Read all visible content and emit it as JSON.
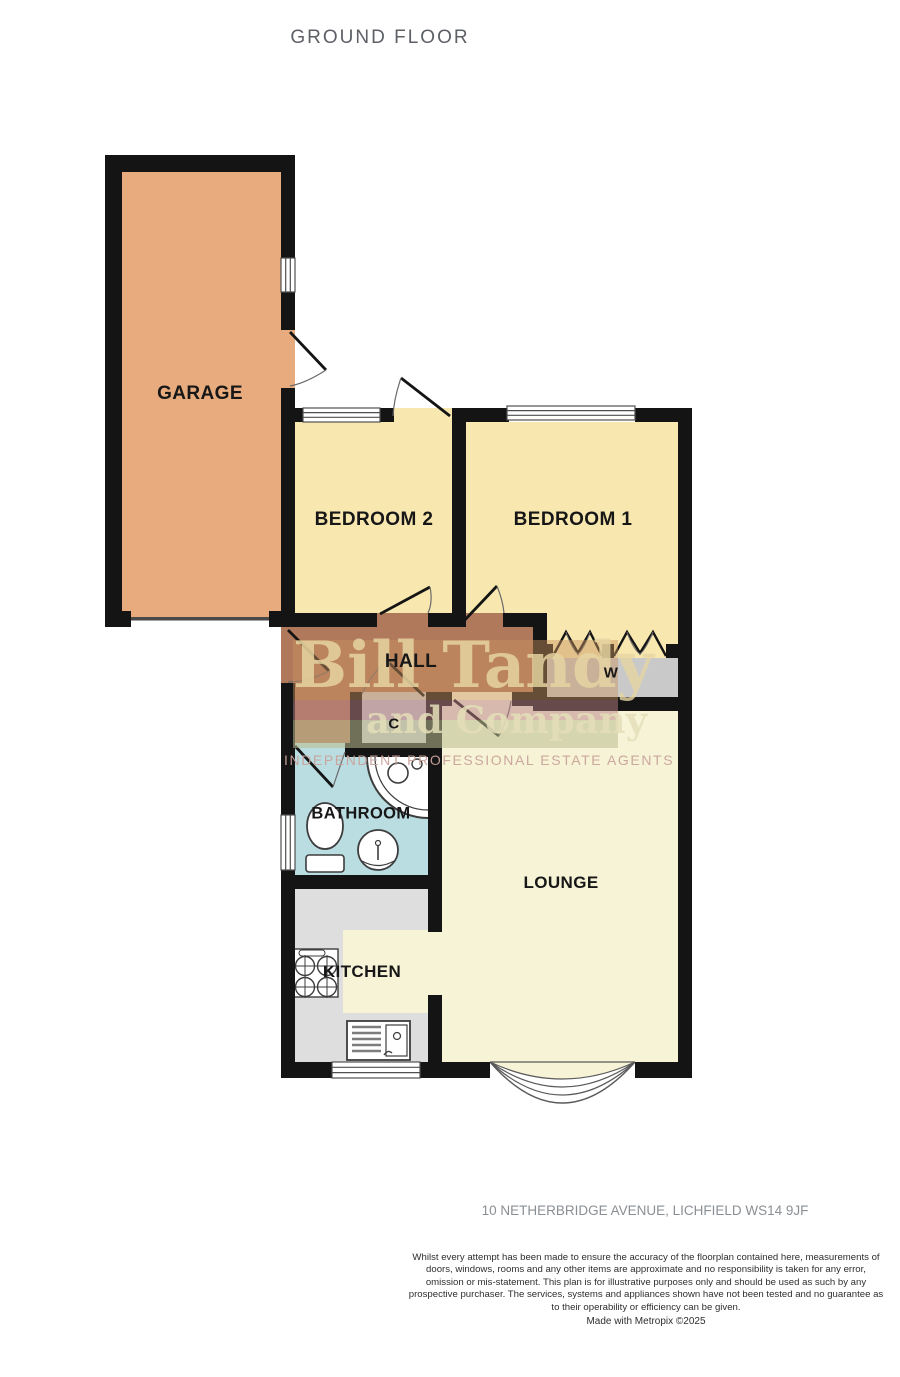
{
  "title": "GROUND FLOOR",
  "rooms": {
    "garage": {
      "label": "GARAGE"
    },
    "bedroom2": {
      "label": "BEDROOM 2"
    },
    "bedroom1": {
      "label": "BEDROOM 1"
    },
    "hall": {
      "label": "HALL"
    },
    "wardrobe": {
      "label": "W"
    },
    "cupboard": {
      "label": "C"
    },
    "bathroom": {
      "label": "BATHROOM"
    },
    "lounge": {
      "label": "LOUNGE"
    },
    "kitchen": {
      "label": "KITCHEN"
    }
  },
  "watermark": {
    "name": "Bill Tandy",
    "suffix": "and Company",
    "tagline": "INDEPENDENT PROFESSIONAL ESTATE AGENTS"
  },
  "footer": {
    "address": "10 NETHERBRIDGE AVENUE, LICHFIELD WS14 9JF",
    "disclaimer": "Whilst every attempt has been made to ensure the accuracy of the floorplan contained here, measurements of doors, windows, rooms and any other items are approximate and no responsibility is taken for any error, omission or mis-statement. This plan is for illustrative purposes only and should be used as such by any prospective purchaser. The services, systems and appliances shown have not been tested and no guarantee as to their operability or efficiency can be given.",
    "credit": "Made with Metropix ©2025"
  },
  "colors": {
    "wall": "#141414",
    "garage_floor": "#e7ab7d",
    "bedroom_floor": "#f8e8b0",
    "hall_floor": "#b1795c",
    "bathroom_floor": "#badde2",
    "lounge_floor": "#f7f3d7",
    "kitchen_floor": "#dedede",
    "storage_floor": "#c9c9c9",
    "watermark_text": "#e7d5a2",
    "title_text": "#5d6066"
  }
}
